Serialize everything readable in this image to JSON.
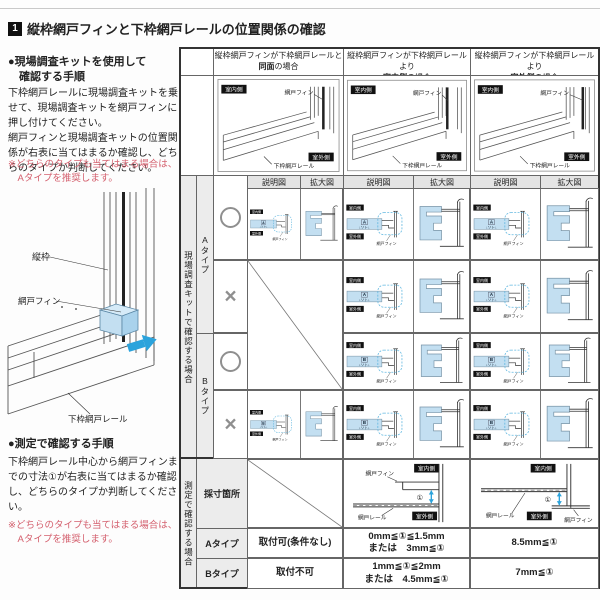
{
  "page": {
    "title_no": "1",
    "title": "縦枠網戸フィンと下枠網戸レールの位置関係の確認"
  },
  "left_panel": {
    "kit_method": {
      "heading1": "●現場調査キットを使用して",
      "heading2": "確認する手順",
      "body": "下枠網戸レールに現場調査キットを乗せて、現場調査キットを網戸フィンに押し付けてください。\n網戸フィンと現場調査キットの位置関係が右表に当てはまるか確認し、どちらのタイプか判断してください。",
      "note": "※どちらのタイプも当てはまる場合は、\n　Aタイプを推奨します。"
    },
    "diagram_labels": {
      "frame": "縦枠",
      "fin": "網戸フィン",
      "rail": "下枠網戸レール"
    },
    "measure_method": {
      "heading": "●測定で確認する手順",
      "body": "下枠網戸レール中心から網戸フィンまでの寸法①が右表に当てはまるか確認し、どちらのタイプか判断してください。",
      "note": "※どちらのタイプも当てはまる場合は、\n　Aタイプを推奨します。"
    }
  },
  "table": {
    "col_headers": [
      {
        "line1": "縦枠網戸フィンが下枠網戸レールと",
        "em": "同面",
        "tail": "の場合"
      },
      {
        "line1": "縦枠網戸フィンが下枠網戸レールより",
        "em": "室内側",
        "tail": "の場合"
      },
      {
        "line1": "縦枠網戸フィンが下枠網戸レールより",
        "em": "室外側",
        "tail": "の場合"
      }
    ],
    "badge_indoor": "室内側",
    "badge_outdoor": "室外側",
    "label_fin": "網戸フィン",
    "label_rail": "下枠網戸レール",
    "label_rail_short": "網戸レール",
    "kit_soto": "ソト",
    "dim_mark": "①",
    "kit_section": {
      "side_label": "現場調査キットで確認する場合",
      "sub_schematic": "説明図",
      "sub_enlarged": "拡大図",
      "type_a": "Aタイプ",
      "type_b": "Bタイプ",
      "rows": [
        {
          "type": "A",
          "mark": "○",
          "cells": [
            1,
            1,
            1
          ]
        },
        {
          "type": "A",
          "mark": "×",
          "cells": [
            0,
            1,
            1
          ]
        },
        {
          "type": "B",
          "mark": "○",
          "cells": [
            0,
            1,
            1
          ]
        },
        {
          "type": "B",
          "mark": "×",
          "cells": [
            1,
            1,
            1
          ]
        }
      ]
    },
    "measure_section": {
      "side_label": "測定で確認する場合",
      "row_label_spot": "採寸箇所",
      "row_label_a": "Aタイプ",
      "row_label_b": "Bタイプ",
      "results_a": [
        "取付可(条件なし)",
        "0mm≦①≦1.5mm\nまたは　3mm≦①",
        "8.5mm≦①"
      ],
      "results_b": [
        "取付不可",
        "1mm≦①≦2mm\nまたは　4.5mm≦①",
        "7mm≦①"
      ]
    }
  },
  "colors": {
    "accent_blue": "#2ba3dc",
    "fill_blue": "#c3dff1",
    "fill_blue_dark": "#a9d2ec",
    "highlight_dash": "#62b8e0",
    "note_red": "#d4606e",
    "badge_bg": "#111111"
  }
}
